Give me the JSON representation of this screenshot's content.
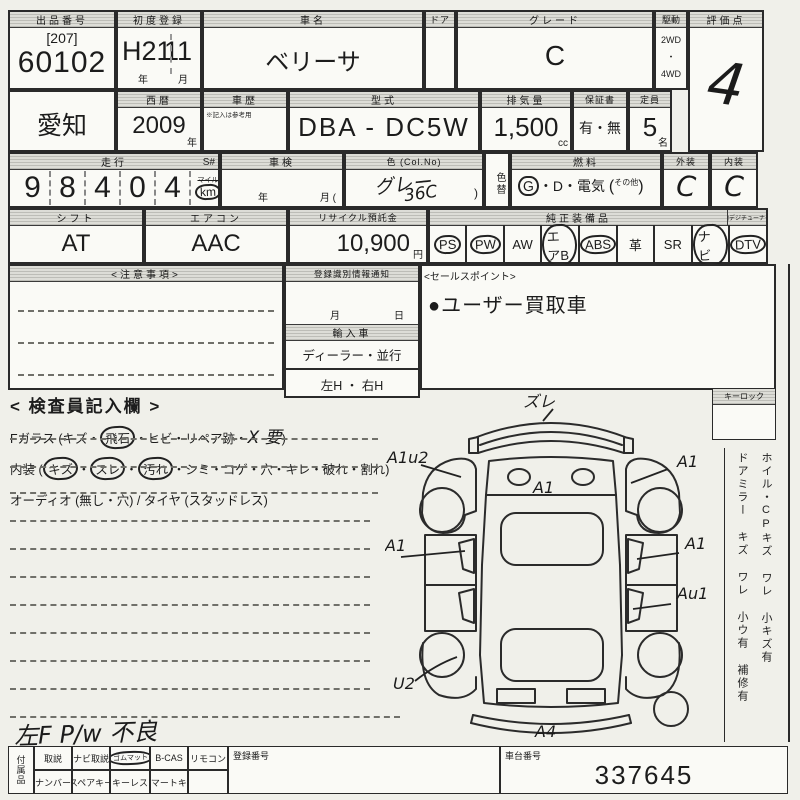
{
  "header": {
    "lot": {
      "label": "出品番号",
      "bracket": "[207]",
      "number": "60102"
    },
    "first_reg": {
      "label": "初度登録",
      "era": "H21",
      "month": "11",
      "unit_year": "年",
      "unit_month": "月"
    },
    "car_name": {
      "label": "車名",
      "value": "ベリーサ"
    },
    "door": {
      "label": "ドア"
    },
    "grade": {
      "label": "グレード",
      "value": "C"
    },
    "drive": {
      "label": "駆動",
      "top": "2WD",
      "dot": "・",
      "bottom": "4WD"
    },
    "score": {
      "label": "評価点",
      "value": "4"
    }
  },
  "registration": {
    "region": "愛知",
    "year": {
      "label": "西暦",
      "value": "2009",
      "unit": "年"
    },
    "history": {
      "label": "車歴",
      "note": "※記入は参考用"
    },
    "model": {
      "label": "型式",
      "value": "DBA - DC5W"
    },
    "displacement": {
      "label": "排気量",
      "value": "1,500",
      "unit": "cc"
    },
    "warranty": {
      "label": "保証書",
      "options": "有・無"
    },
    "capacity": {
      "label": "定員",
      "value": "5",
      "unit": "名"
    }
  },
  "condition": {
    "mileage": {
      "label": "走行",
      "s": "S#",
      "digits": [
        "9",
        "8",
        "4",
        "0",
        "4"
      ],
      "unit_top": "マイル",
      "unit": "km"
    },
    "shaken": {
      "label": "車検",
      "unit_year": "年",
      "unit_month": "月 ("
    },
    "color": {
      "label": "色 (Col.No)",
      "value": "グレー",
      "code": "36C",
      "close": ")"
    },
    "color_change": {
      "label": "色替"
    },
    "fuel": {
      "label": "燃料",
      "g": "G",
      "rest": "・D・電気",
      "open": "(",
      "other": "その他",
      "close": ")"
    },
    "exterior": {
      "label": "外装",
      "value": "C"
    },
    "interior": {
      "label": "内装",
      "value": "C"
    }
  },
  "equipment_row": {
    "shift": {
      "label": "シフト",
      "value": "AT"
    },
    "aircon": {
      "label": "エアコン",
      "value": "AAC"
    },
    "recycle": {
      "label": "リサイクル預託金",
      "value": "10,900",
      "unit": "円"
    },
    "equipment": {
      "label": "純正装備品",
      "tuner": "地デジチューナー",
      "items": [
        "PS",
        "PW",
        "AW",
        "エアB",
        "ABS",
        "革",
        "SR",
        "ナビ",
        "DTV"
      ]
    }
  },
  "notes": {
    "title": "<注意事項>"
  },
  "reg_info": {
    "title": "登録識別情報通知",
    "month": "月",
    "day": "日",
    "import_label": "輸入車",
    "import_options": "ディーラー・並行",
    "handle_options": "左H ・ 右H"
  },
  "sales_point": {
    "title": "<セールスポイント>",
    "text": "●ユーザー買取車"
  },
  "inspector": {
    "title": "< 検査員記入欄 >",
    "fglass": {
      "pre": "Fガラス (キズ・",
      "c1": "飛石",
      "mid": "・ヒビ・リペア跡・",
      "hand": "X 要",
      "post": ")"
    },
    "interior_line": {
      "pre": "内装 (",
      "c1": "キズ",
      "d1": "・",
      "c2": "スレ",
      "d2": "・",
      "c3": "汚れ",
      "post": "・シミ・コゲ・穴・キレ・破れ・割れ)"
    },
    "audio": "オーディオ (無し・穴) / タイヤ (スタッドレス)",
    "hand_note": "左F P/w 不良"
  },
  "diagram": {
    "annotations": {
      "front_bumper": "ズレ",
      "lf_fender": "A1u2",
      "rf_fender": "A1",
      "hood": "A1",
      "l_door": "A1",
      "r_door": "A1",
      "r_rear": "Au1",
      "l_rear": "U2",
      "rear_bumper": "A4"
    }
  },
  "sidebar": {
    "keylock": "キーロック",
    "line1": "ホイル・CPキズ ワレ 小キズ有",
    "line2": "ドアミラー キズ ワレ 小ウ有 補修有"
  },
  "footer": {
    "side_label": "付属品",
    "row1": [
      "取説",
      "ナビ取説",
      "ゴムマット",
      "B-CAS",
      "リモコン"
    ],
    "row2": [
      "ナンバー",
      "スペアキー",
      "キーレス",
      "スマートキー"
    ],
    "reg_no_label": "登録番号",
    "chassis_label": "車台番号",
    "chassis_value": "337645"
  }
}
